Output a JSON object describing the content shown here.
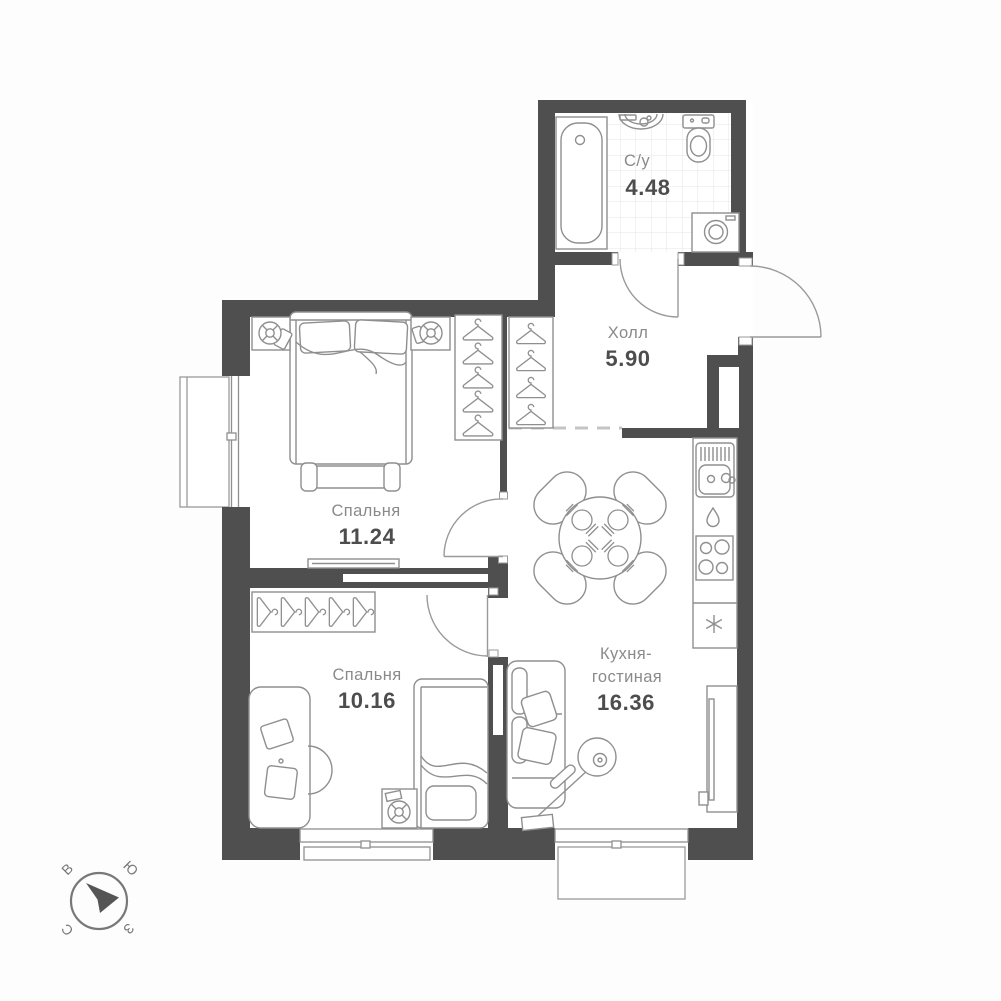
{
  "plan": {
    "rooms": {
      "bathroom": {
        "name": "С/у",
        "area": "4.48"
      },
      "hall": {
        "name": "Холл",
        "area": "5.90"
      },
      "bedroom_top": {
        "name": "Спальня",
        "area": "11.24"
      },
      "bedroom_bottom": {
        "name": "Спальня",
        "area": "10.16"
      },
      "kitchen_living": {
        "name_line1": "Кухня-",
        "name_line2": "гостиная",
        "area": "16.36"
      }
    },
    "compass": {
      "north": "С",
      "south": "Ю",
      "east": "В",
      "west": "З"
    }
  },
  "colors": {
    "wall": "#4f4f4f",
    "furniture": "#8f8f8f",
    "room_name": "#8a8a8a",
    "room_area": "#4d4d4d",
    "compass": "#787878",
    "tile_line": "#e4e4e4",
    "dashed_opening": "#c4c4c4"
  }
}
